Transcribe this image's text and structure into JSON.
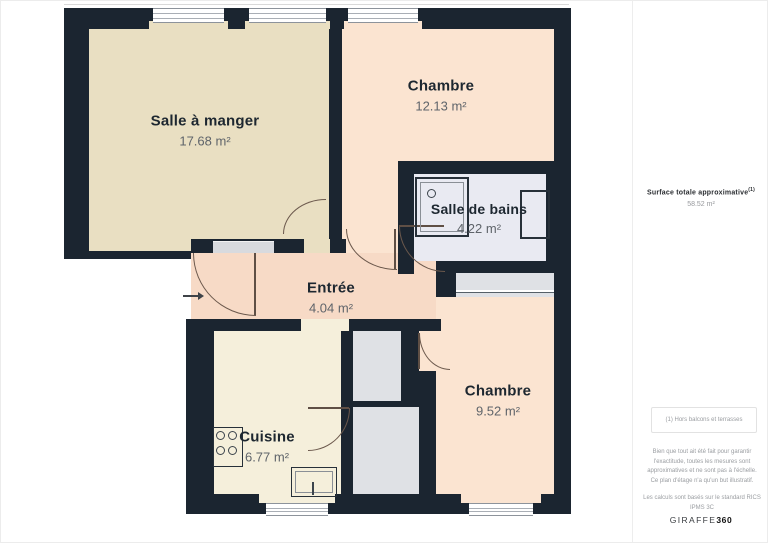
{
  "plan": {
    "rooms": [
      {
        "id": "salle_a_manger",
        "name": "Salle à manger",
        "area": "17.68 m²"
      },
      {
        "id": "chambre_1",
        "name": "Chambre",
        "area": "12.13 m²"
      },
      {
        "id": "salle_de_bains",
        "name": "Salle de bains",
        "area": "4.22 m²"
      },
      {
        "id": "entree",
        "name": "Entrée",
        "area": "4.04 m²"
      },
      {
        "id": "chambre_2",
        "name": "Chambre",
        "area": "9.52 m²"
      },
      {
        "id": "cuisine",
        "name": "Cuisine",
        "area": "6.77 m²"
      }
    ],
    "colors": {
      "wall": "#1b2530",
      "dining": "#e9dfc2",
      "bedroom": "#fbe4d1",
      "bathroom": "#e9eaf2",
      "entree": "#f7dac6",
      "kitchen": "#f5efdb",
      "closet": "#dfe1e5"
    }
  },
  "sidebar": {
    "total_label": "Surface totale approximative",
    "total_sup": "(1)",
    "total_value": "58.52 m²",
    "footnote": "(1) Hors balcons et terrasses",
    "disclaimer": "Bien que tout ait été fait pour garantir l'exactitude, toutes les mesures sont approximatives et ne sont pas à l'échelle. Ce plan d'étage n'a qu'un but illustratif.",
    "standard": "Les calculs sont basés sur le standard RICS IPMS 3C",
    "brand": {
      "name": "GIRAFFE",
      "suffix": "360"
    }
  }
}
